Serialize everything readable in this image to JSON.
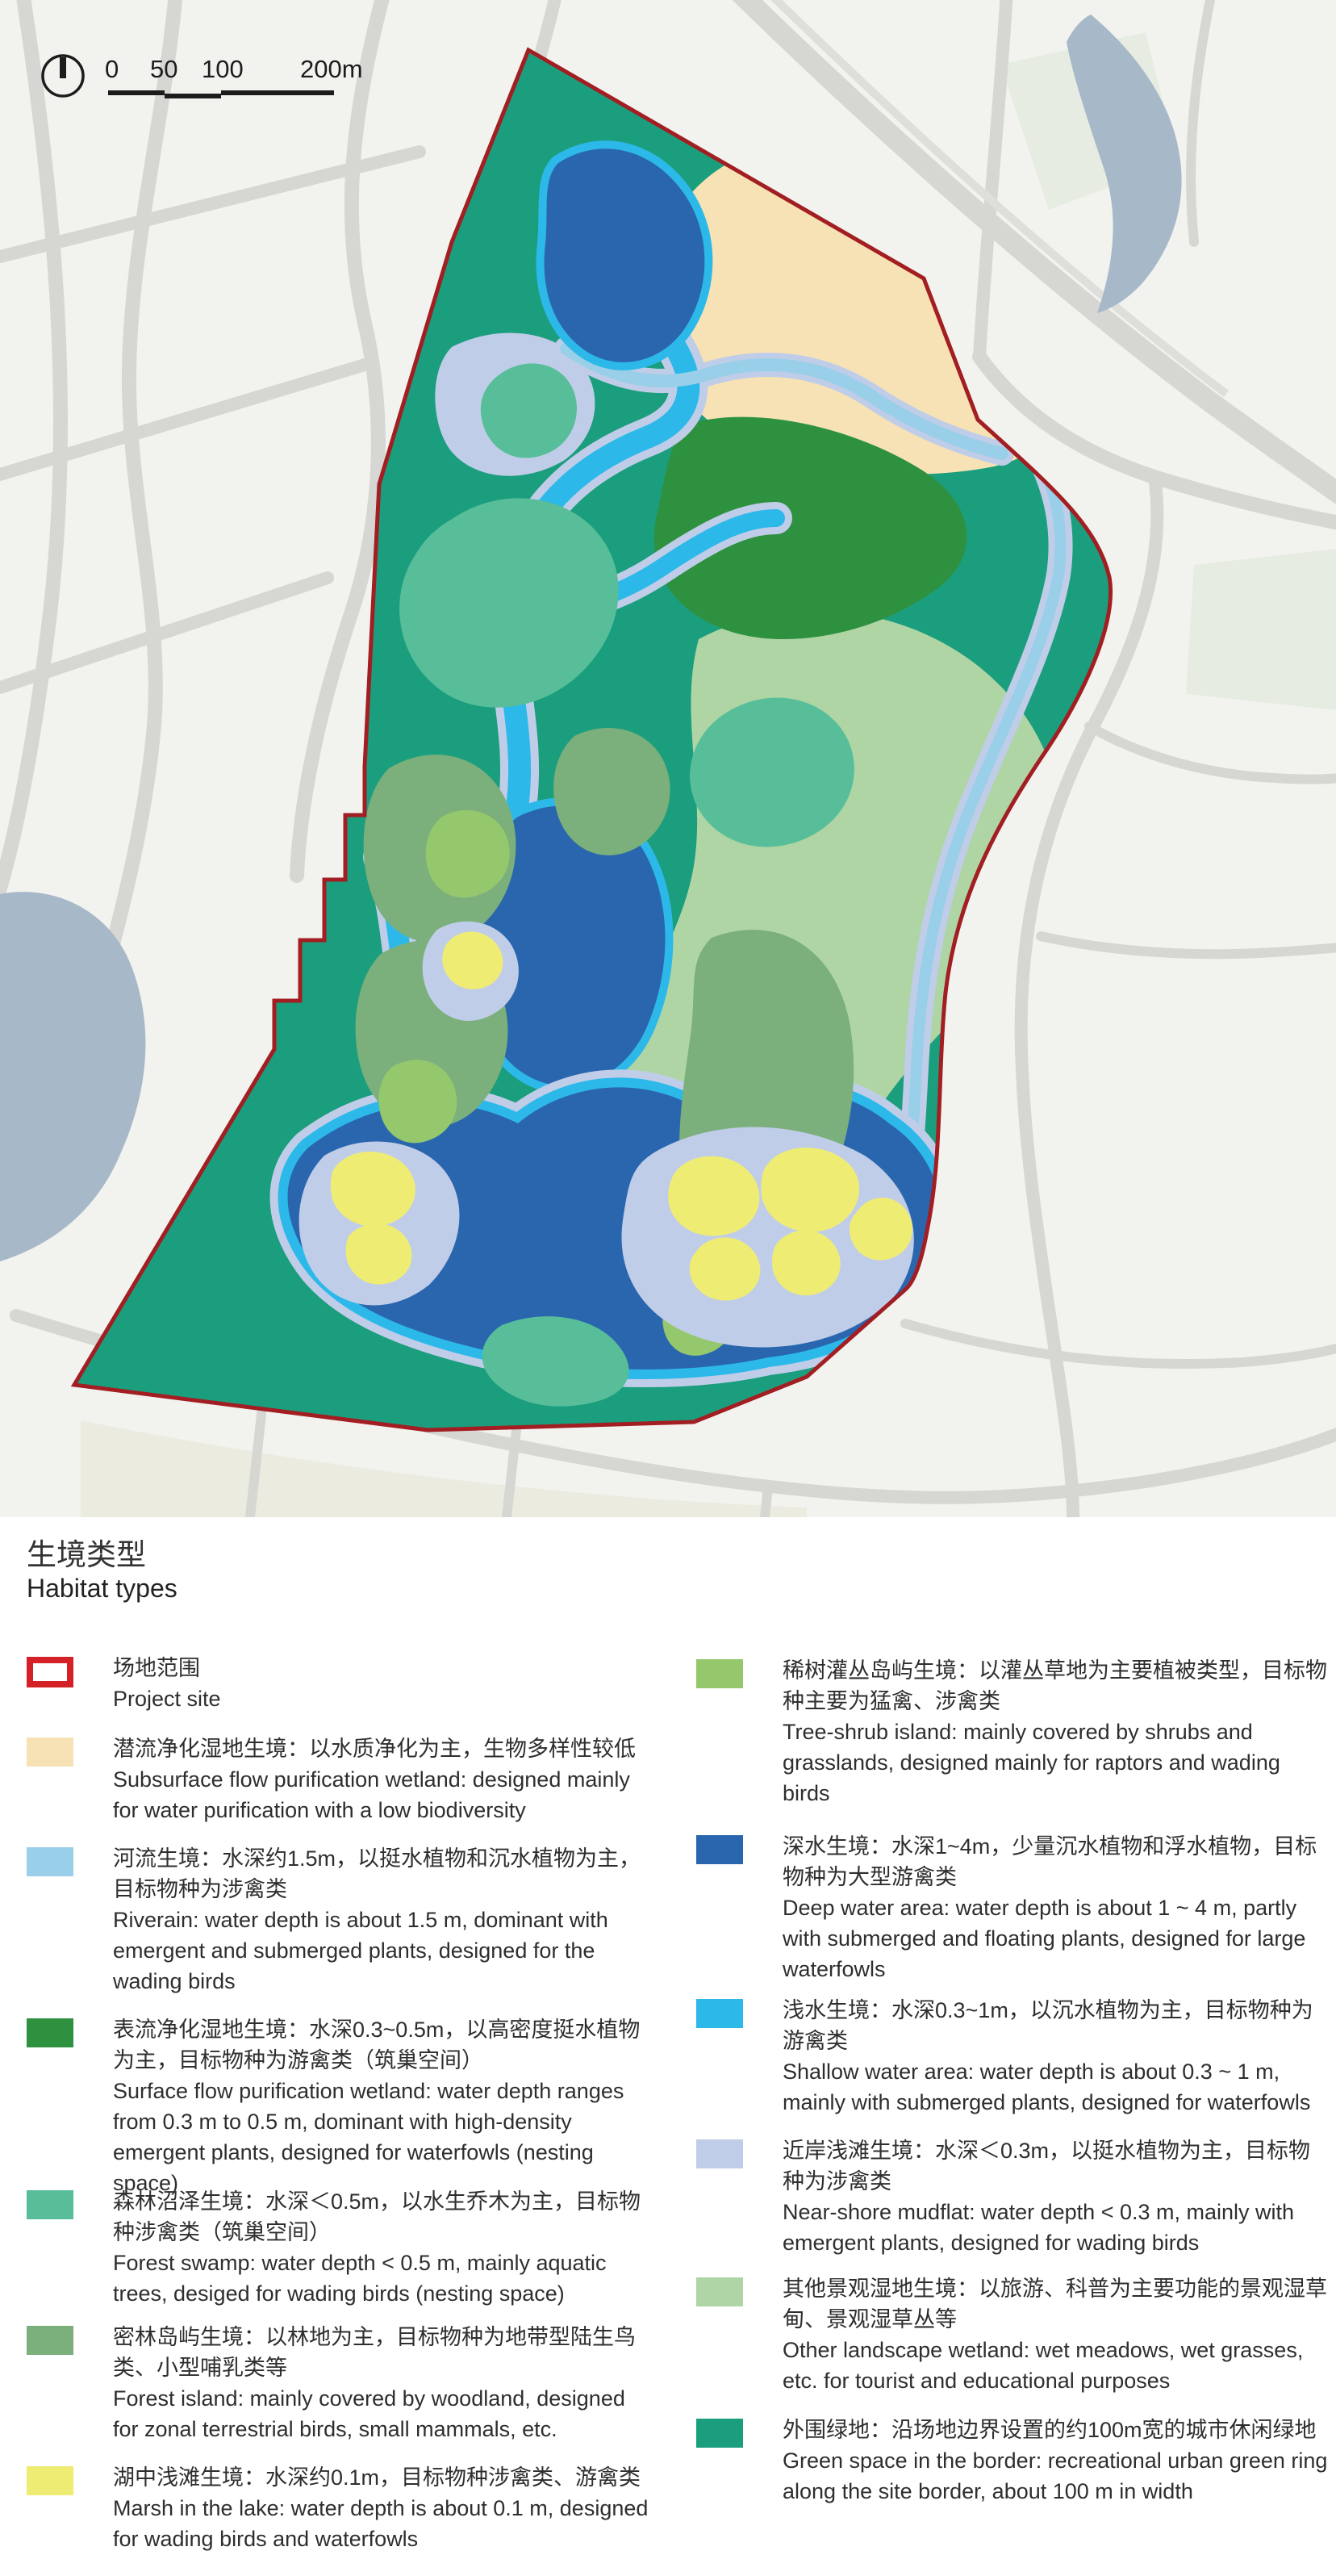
{
  "title": {
    "zh": "生境类型",
    "en": "Habitat types"
  },
  "scalebar": {
    "labels": [
      "0",
      "50",
      "100",
      "200m"
    ]
  },
  "icons": {
    "north_arrow": "compass-north-arrow"
  },
  "colors": {
    "site_red": "#D42127",
    "map_border_red": "#A21E22",
    "subsurface_cream": "#F7E2B5",
    "riverain_blue": "#99CFE8",
    "surface_green": "#2E9140",
    "forest_swamp_teal": "#58BE9A",
    "forest_island_green": "#7BAF7B",
    "marsh_yellow": "#EFEC74",
    "treeshrub_green": "#95C76C",
    "deep_water_blue": "#2A66AE",
    "shallow_cyan": "#2CB9E9",
    "mudflat_periwinkle": "#C0CDE8",
    "other_wetland_green": "#AFD5A5",
    "border_green": "#1B9E7D",
    "map_bg": "#F2F3EF",
    "road_gray": "#D6D7D3",
    "road_light": "#DEDFDB",
    "water_gray_blue": "#A7B8C9",
    "block_tint_green": "#E7ECE2",
    "bottom_beige": "#EAE8DC"
  },
  "legend": {
    "left": [
      {
        "id": "project-site",
        "zh": "场地范围",
        "en": "Project site"
      },
      {
        "id": "subsurface-flow-purification-wetland",
        "zh": "潜流净化湿地生境：以水质净化为主，生物多样性较低",
        "en": "Subsurface flow purification wetland: designed mainly for water purification with a low biodiversity"
      },
      {
        "id": "riverain",
        "zh": "河流生境：水深约1.5m，以挺水植物和沉水植物为主，目标物种为涉禽类",
        "en": "Riverain: water depth is about 1.5 m, dominant with emergent and submerged plants, designed for the wading birds"
      },
      {
        "id": "surface-flow-purification-wetland",
        "zh": "表流净化湿地生境：水深0.3~0.5m，以高密度挺水植物为主，目标物种为游禽类（筑巢空间）",
        "en": "Surface flow purification wetland: water depth ranges from 0.3 m to 0.5 m, dominant with high-density emergent plants, designed for waterfowls (nesting space)"
      },
      {
        "id": "forest-swamp",
        "zh": "森林沼泽生境：水深＜0.5m，以水生乔木为主，目标物种涉禽类（筑巢空间）",
        "en": "Forest swamp: water depth < 0.5 m, mainly aquatic trees, desiged for wading birds (nesting space)"
      },
      {
        "id": "forest-island",
        "zh": "密林岛屿生境：以林地为主，目标物种为地带型陆生鸟类、小型哺乳类等",
        "en": "Forest island: mainly covered by woodland, designed for zonal terrestrial birds, small mammals, etc."
      },
      {
        "id": "marsh-in-the-lake",
        "zh": "湖中浅滩生境：水深约0.1m，目标物种涉禽类、游禽类",
        "en": "Marsh in the lake: water depth is about 0.1 m, designed for wading birds and waterfowls"
      }
    ],
    "right": [
      {
        "id": "tree-shrub-island",
        "zh": "稀树灌丛岛屿生境：以灌丛草地为主要植被类型，目标物种主要为猛禽、涉禽类",
        "en": "Tree-shrub island: mainly covered by shrubs and grasslands, designed mainly for raptors and wading birds"
      },
      {
        "id": "deep-water-area",
        "zh": "深水生境：水深1~4m，少量沉水植物和浮水植物，目标物种为大型游禽类",
        "en": "Deep water area: water depth is about 1 ~ 4 m, partly with submerged and floating plants, designed for large waterfowls"
      },
      {
        "id": "shallow-water-area",
        "zh": "浅水生境：水深0.3~1m，以沉水植物为主，目标物种为游禽类",
        "en": "Shallow water area: water depth is about 0.3 ~ 1 m, mainly with submerged plants, designed for waterfowls"
      },
      {
        "id": "near-shore-mudflat",
        "zh": "近岸浅滩生境：水深＜0.3m，以挺水植物为主，目标物种为涉禽类",
        "en": "Near-shore mudflat: water depth < 0.3 m, mainly with emergent plants, designed for wading birds"
      },
      {
        "id": "other-landscape-wetland",
        "zh": "其他景观湿地生境：以旅游、科普为主要功能的景观湿草甸、景观湿草丛等",
        "en": "Other landscape wetland: wet meadows, wet grasses, etc. for tourist and educational purposes"
      },
      {
        "id": "green-space-border",
        "zh": "外围绿地：沿场地边界设置的约100m宽的城市休闲绿地",
        "en": "Green space in the border: recreational urban green ring along the site border, about 100 m in width"
      }
    ]
  }
}
